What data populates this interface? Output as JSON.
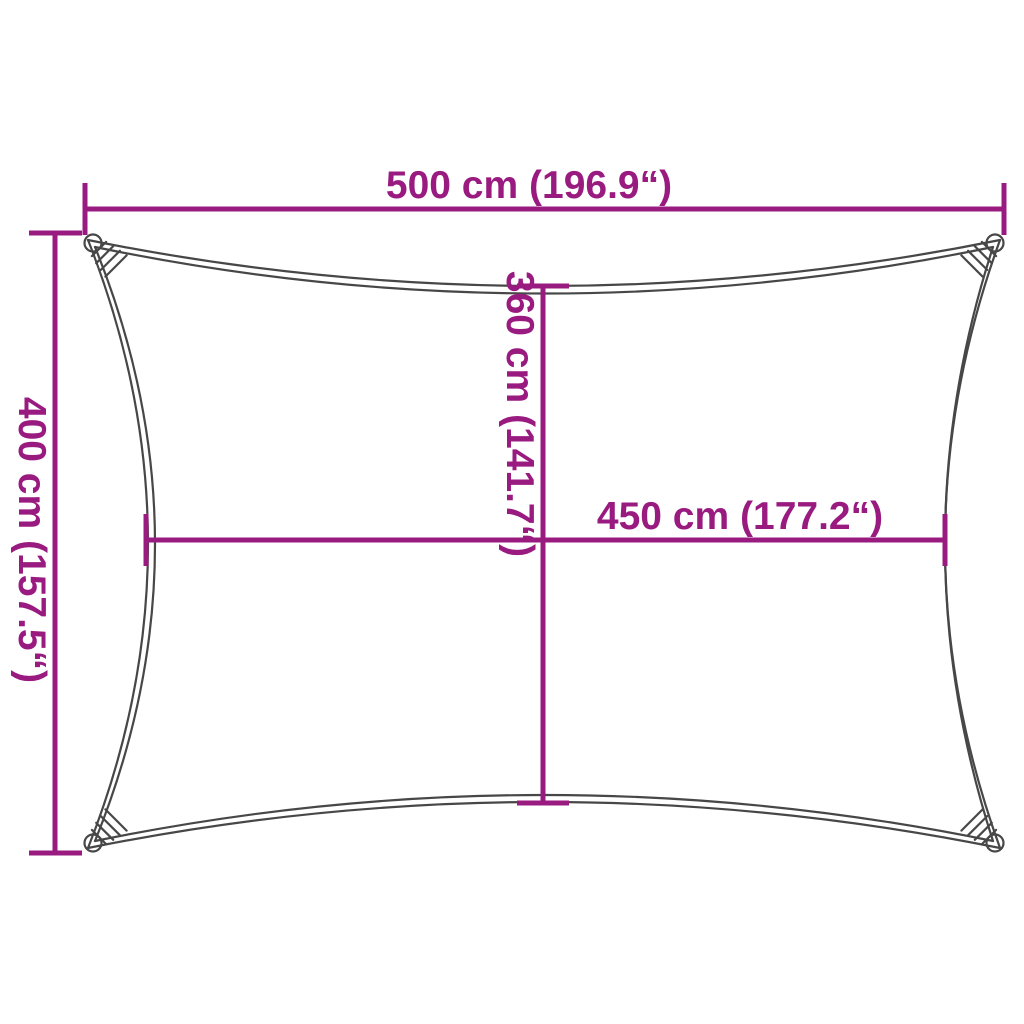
{
  "colors": {
    "dimension_accent": "#9a1b80",
    "sail_outline": "#474747",
    "background": "#ffffff"
  },
  "diagram": {
    "description": "Rectangular shade sail with concave curved edges, corner attachment loops with lacing, annotated with dimension lines",
    "dims": {
      "top": {
        "label": "500 cm (196.9“)"
      },
      "left": {
        "label": "400 cm (157.5“)"
      },
      "middle_vertical": {
        "label": "360 cm (141.7“)"
      },
      "middle_horizontal": {
        "label": "450 cm (177.2“)"
      }
    }
  }
}
